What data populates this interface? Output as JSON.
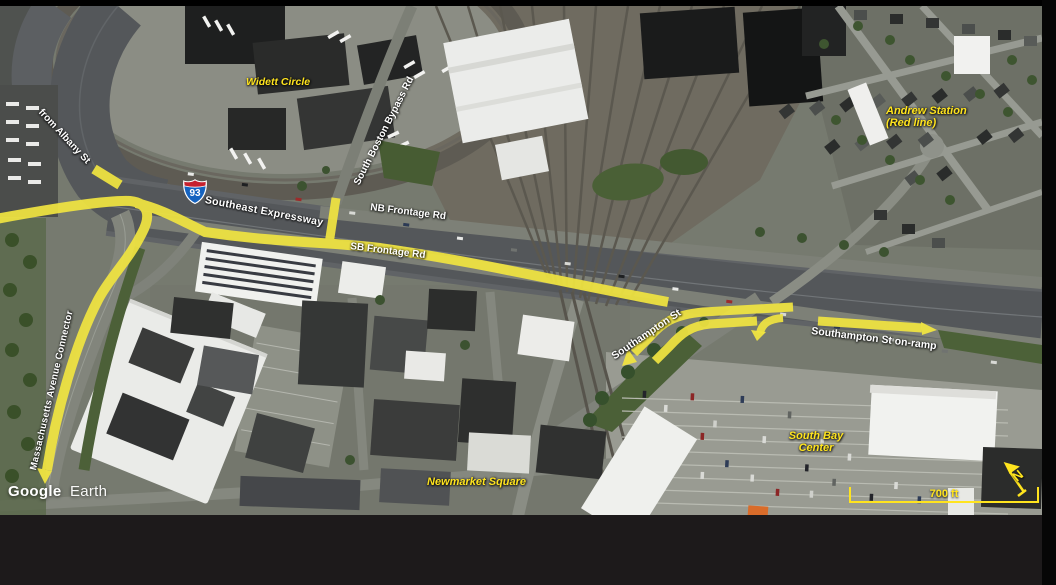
{
  "map": {
    "attribution_brand": "Google",
    "attribution_product": "Earth",
    "scale_bar": {
      "label": "700 ft"
    },
    "north_indicator": {
      "label": "N"
    },
    "route_shield": {
      "interstate": "93"
    },
    "labels": {
      "from_albany_st": "from Albany St",
      "widett_circle": "Widett Circle",
      "southeast_expressway": "Southeast Expressway",
      "south_boston_bypass_rd": "South Boston Bypass Rd",
      "nb_frontage_rd": "NB Frontage Rd",
      "sb_frontage_rd": "SB Frontage Rd",
      "andrew_station": "Andrew Station\n(Red line)",
      "southampton_st": "Southampton St",
      "southampton_st_on_ramp": "Southampton St on-ramp",
      "massachusetts_avenue_connector": "Massachusetts Avenue Connector",
      "newmarket_square": "Newmarket Square",
      "south_bay_center": "South Bay\nCenter"
    },
    "colors": {
      "route_highlight": "#f0e441",
      "place_label_yellow": "#ffe41e",
      "road_label_white": "#ffffff"
    }
  }
}
